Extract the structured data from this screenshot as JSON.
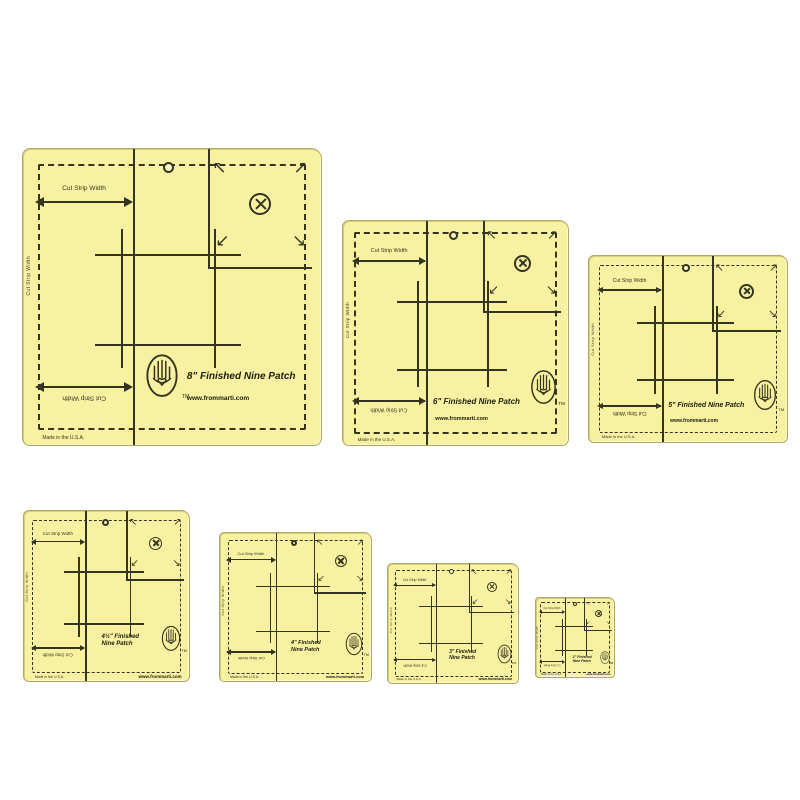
{
  "page": {
    "background": "#ffffff"
  },
  "colors": {
    "plastic_yellow": "#f8f1a2",
    "marking_ink": "#35341f",
    "edge": "#b1a65f"
  },
  "brand": {
    "website": "www.frommarti.com",
    "made_in": "Made in the U.S.A.",
    "trademark": "TM"
  },
  "labels": {
    "cut_strip_width": "Cut Strip Width",
    "side_text": "Cut Strip Width"
  },
  "icons": {
    "arrow_nw": "↖",
    "arrow_ne": "↗",
    "arrow_sw": "↙",
    "arrow_se": "↘",
    "circle_x": "circled-x-registration-mark",
    "hang_hole": "hang-hole",
    "hand_logo": "hand-with-heart-logo"
  },
  "templates": [
    {
      "name": "8-inch",
      "title": "8\" Finished Nine Patch",
      "title_line2": "",
      "layout": "logo-left"
    },
    {
      "name": "6-inch",
      "title": "6\" Finished Nine Patch",
      "title_line2": "",
      "layout": "logo-right"
    },
    {
      "name": "5-inch",
      "title": "5\" Finished Nine Patch",
      "title_line2": "",
      "layout": "logo-right"
    },
    {
      "name": "4half-inch",
      "title": "4½\" Finished",
      "title_line2": "Nine Patch",
      "layout": "two-line"
    },
    {
      "name": "4-inch",
      "title": "4\" Finished",
      "title_line2": "Nine Patch",
      "layout": "two-line"
    },
    {
      "name": "3-inch",
      "title": "3\" Finished",
      "title_line2": "Nine Patch",
      "layout": "two-line"
    },
    {
      "name": "2-inch",
      "title": "2\" Finished",
      "title_line2": "Nine Patch",
      "layout": "two-line"
    }
  ]
}
